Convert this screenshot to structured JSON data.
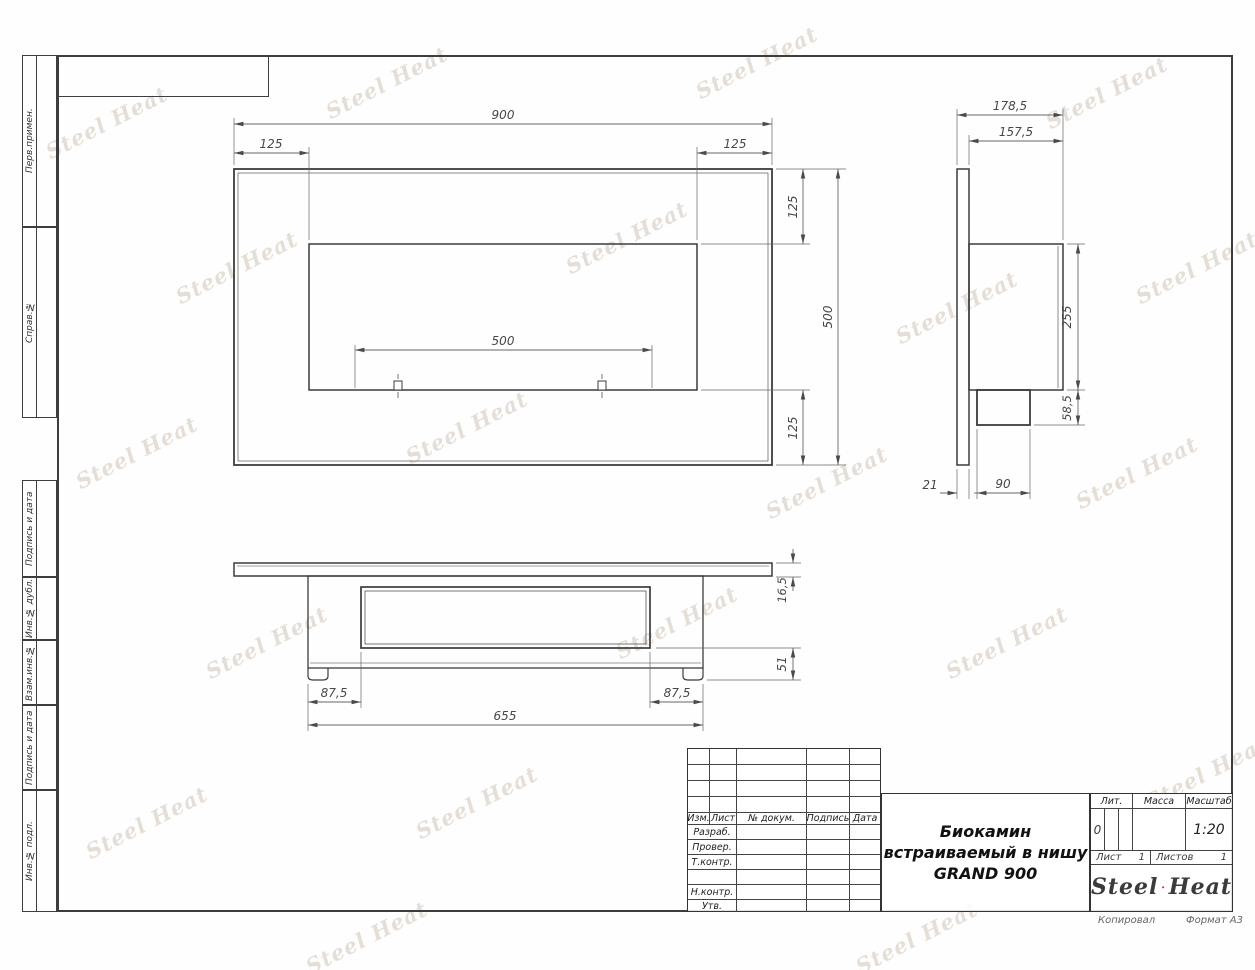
{
  "watermark": {
    "text": "Steel Heat"
  },
  "side_labels": {
    "perv": "Перв.примен.",
    "sprav": "Справ.№",
    "podpis1": "Подпись и дата",
    "inv_dubl": "Инв.№ дубл.",
    "vzam": "Взам.инв.№",
    "podpis2": "Подпись и дата",
    "inv_podl": "Инв.№ подл."
  },
  "title_block": {
    "header_cols": [
      "Изм.",
      "Лист",
      "№ докум.",
      "Подпись",
      "Дата"
    ],
    "rows": [
      "Разраб.",
      "Провер.",
      "Т.контр.",
      "",
      "Н.контр.",
      "Утв."
    ],
    "title_line1": "Биокамин",
    "title_line2": "встраиваемый в нишу",
    "title_line3": "GRAND 900",
    "lit_label": "Лит.",
    "lit_value": "0",
    "massa_label": "Масса",
    "masshtab_label": "Масштаб",
    "masshtab_value": "1:20",
    "list_label": "Лист",
    "list_value": "1",
    "listov_label": "Листов",
    "listov_value": "1",
    "logo_part1": "Steel",
    "logo_part2": "Heat",
    "accent_red": "#e31e24"
  },
  "footer": {
    "copied_label": "Копировал",
    "format_label": "Формат А3"
  },
  "views": {
    "front": {
      "dims": {
        "width_total": "900",
        "inset_left": "125",
        "inset_right": "125",
        "opening_width": "500",
        "height_total": "500",
        "inset_top": "125",
        "inset_bottom": "125"
      }
    },
    "side": {
      "dims": {
        "depth_total": "178,5",
        "depth_body": "157,5",
        "opening_height": "255",
        "burner_height": "58,5",
        "frame_thickness": "21",
        "burner_depth": "90"
      }
    },
    "bottom": {
      "dims": {
        "inset_left": "87,5",
        "inset_right": "87,5",
        "body_width": "655",
        "flange_thickness": "16,5",
        "burner_drop": "51"
      }
    }
  }
}
